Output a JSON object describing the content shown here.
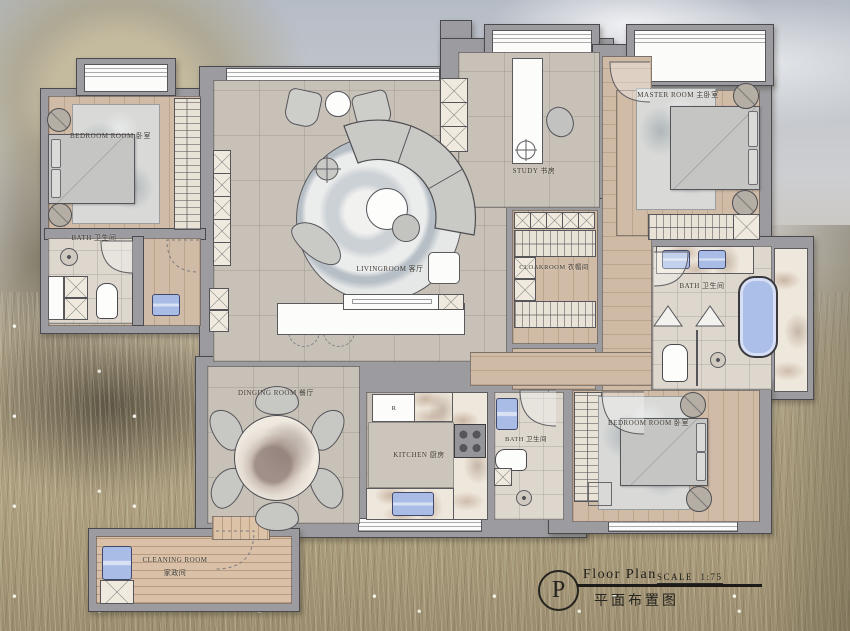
{
  "labels": {
    "bedroom_tl": "BEDROOM ROOM 卧室",
    "bath_left": "BATH 卫生间",
    "living": "LIVINGROOM 客厅",
    "study": "STUDY 书房",
    "master": "MASTER ROOM 主卧室",
    "cloakroom": "CLOAKROOM 衣帽间",
    "bath_right": "BATH 卫生间",
    "dining": "DINGING ROOM 餐厅",
    "kitchen": "KITCHEN 厨房",
    "bath_mid": "BATH 卫生间",
    "bedroom_br": "BEDROOM ROOM 卧室",
    "cleaning_en": "CLEANING ROOM",
    "cleaning_cn": "家政间",
    "fridge": "R"
  },
  "title_block": {
    "monogram": "P",
    "title": "Floor Plan",
    "scale_label": "SCALE",
    "scale_value": "1:75",
    "subtitle": "平面布置图"
  },
  "colors": {
    "wall": "#9c9ca0",
    "wood_floor": "#d0bba7",
    "tile_floor": "#c8c1b7",
    "fixture_blue": "#a8bce6"
  }
}
